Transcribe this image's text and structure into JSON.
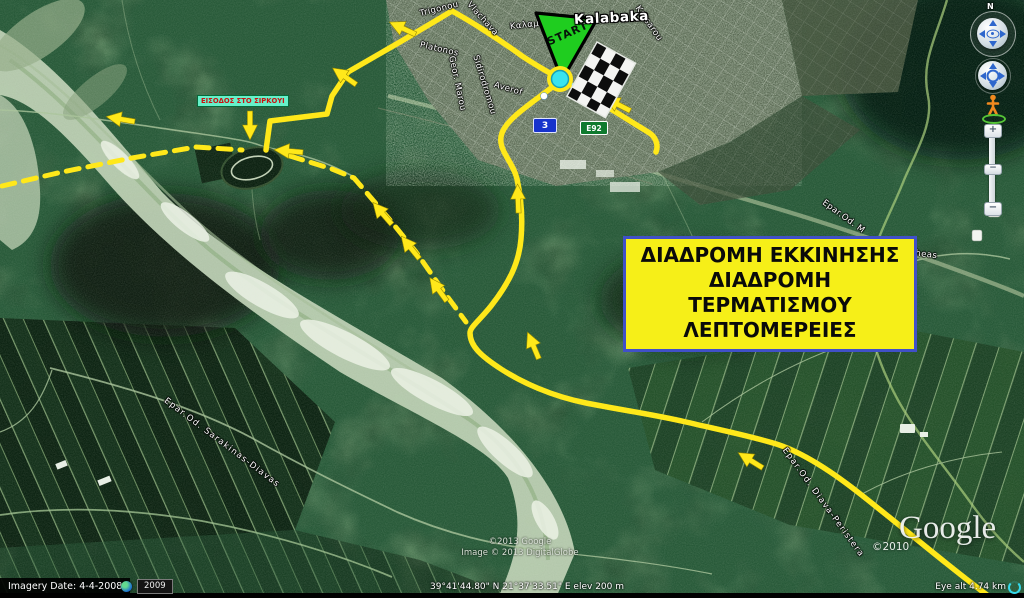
{
  "map": {
    "town": "Kalabaka",
    "streets": {
      "trigonou": "Trigonou",
      "vlachava": "Vlachava",
      "kalam": "Καλαμ",
      "katsarou": "Katsarou",
      "platonos": "Platonos",
      "geor_marou": "Geor. Marou",
      "sidirodromou": "Sidirodromou",
      "averof": "Averof",
      "epar_od_m": "Epar.Od. M",
      "vitheas": "Vitheas",
      "sarakinas_diavas": "Epar.Od. Sarakinas-Diavas",
      "diava_peristera": "Epar.Od. Diava-Peristera"
    },
    "shields": {
      "national_road": "3",
      "european_route": "E92"
    },
    "start_label": "START"
  },
  "annotations": {
    "route_box": {
      "line1": "ΔΙΑΔΡΟΜΗ ΕΚΚΙΝΗΣΗΣ",
      "line2": "ΔΙΑΔΡΟΜΗ ΤΕΡΜΑΤΙΣΜΟΥ",
      "line3": "ΛΕΠΤΟΜΕΡΕΙΕΣ"
    },
    "circuit_entrance_label": "ΕΙΣΟΔΟΣ ΣΤΟ ΣΙΡΚΟΥΙ"
  },
  "watermarks": {
    "logo_year": "©2010",
    "logo_text": "Google",
    "attribution_line1": "©2013 Google",
    "attribution_line2": "Image © 2013 DigitalGlobe"
  },
  "status_bar": {
    "imagery_date": "Imagery Date: 4-4-2008",
    "history_year": "2009",
    "coordinates": "39°41'44.80\" N   21°37'33.51\" E   elev   200 m",
    "eye_altitude": "Eye alt   4.74 km"
  },
  "controls": {
    "north": "N",
    "zoom_in": "+",
    "zoom_out": "−",
    "zoom_handle": "−"
  },
  "colors": {
    "route_yellow": "#ffe81a",
    "route_box_bg": "#f6ef18",
    "route_box_border": "#4050c8",
    "start_green": "#1fcd1f",
    "marker_cyan": "#3ae4ee",
    "entrance_label_bg": "#66f0c9",
    "entrance_label_text": "#cc1111"
  }
}
